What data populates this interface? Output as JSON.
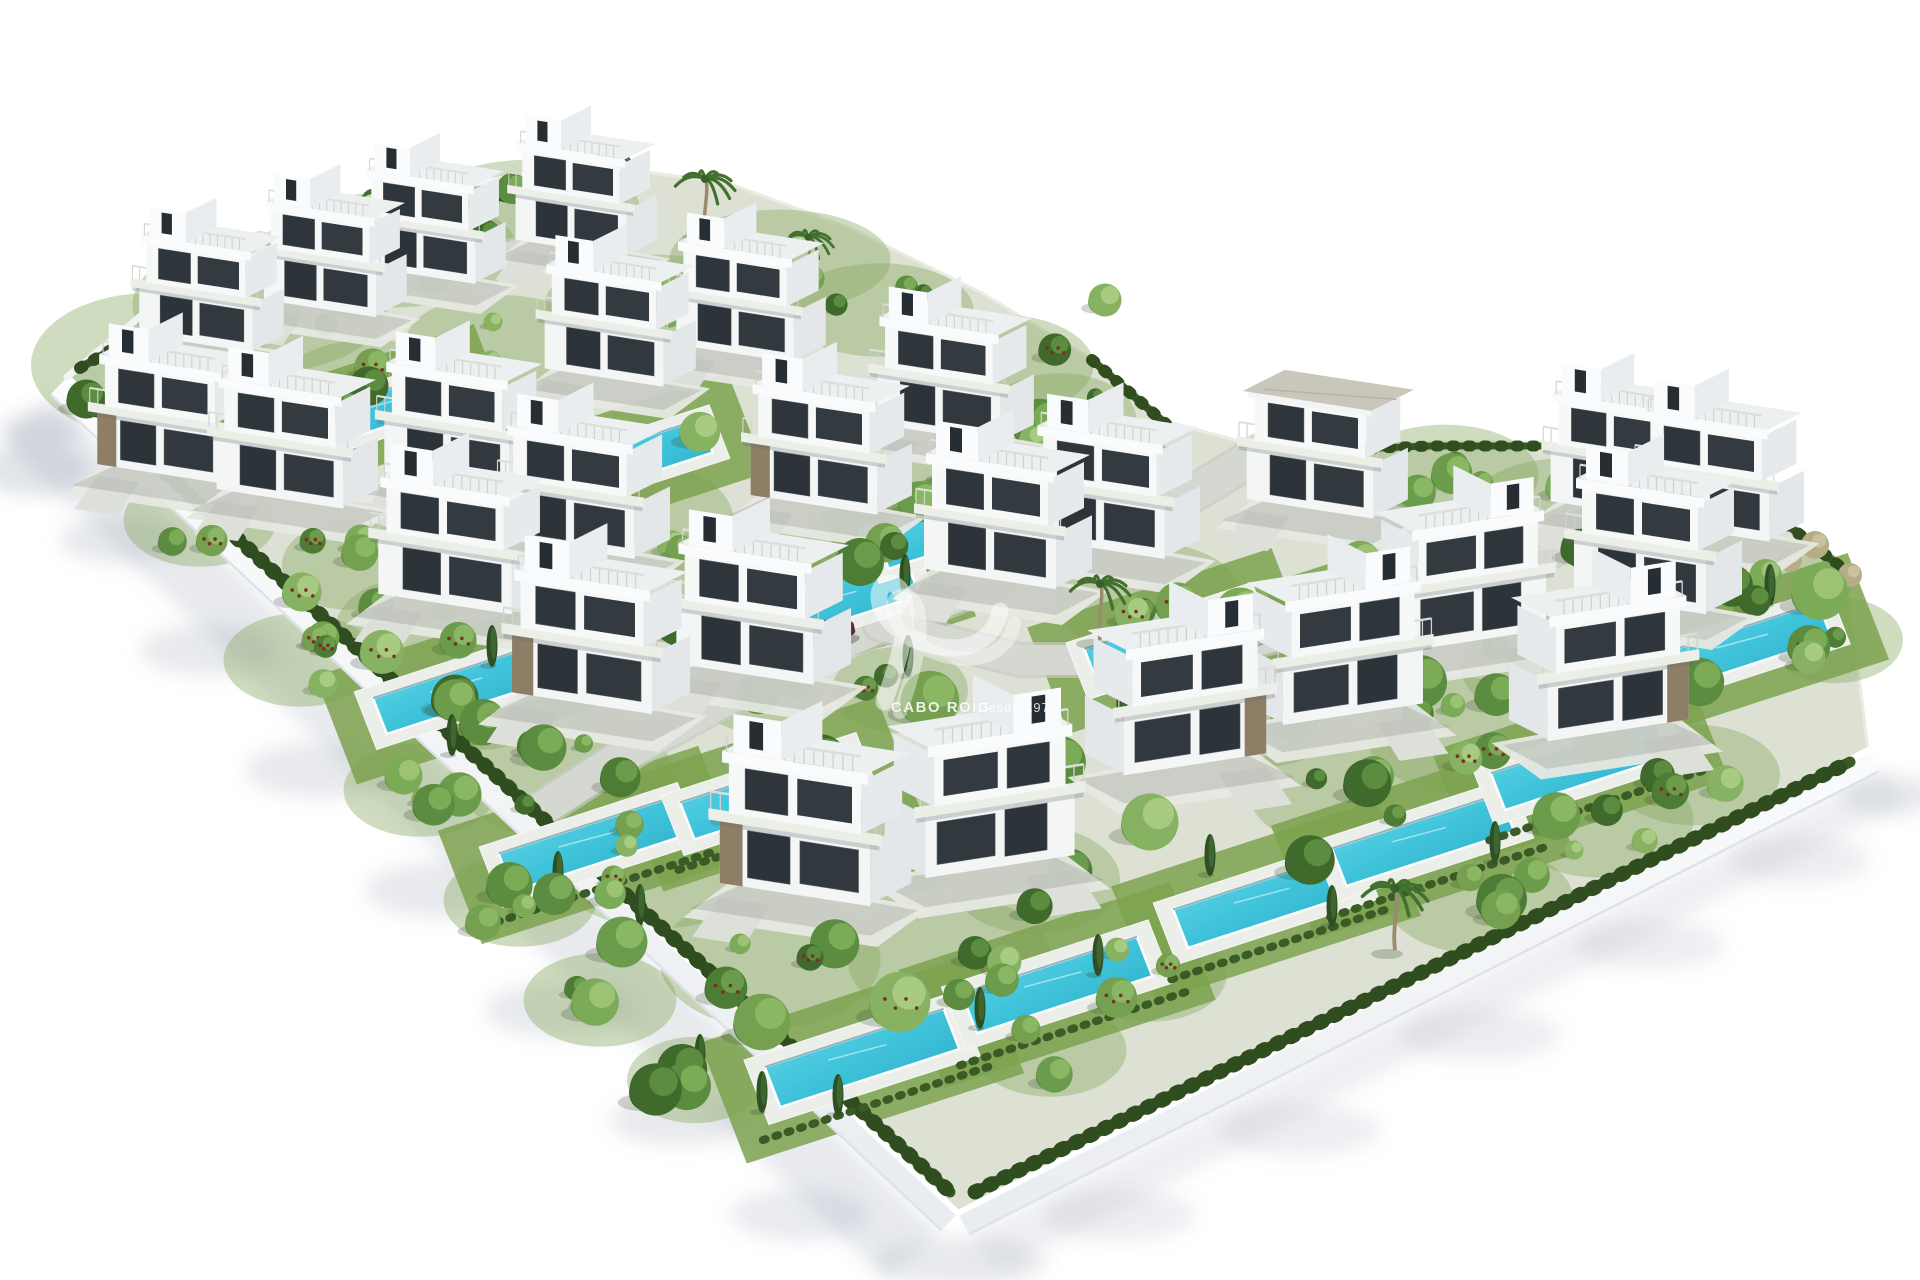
{
  "watermark": {
    "brand": "CABO ROIG",
    "tagline": "Desde 1970",
    "logo_icon": "siv-swoosh-monogram-icon"
  },
  "palette": {
    "background": "#ffffff",
    "ground": "#dde1d4",
    "grass": "#7ca24f",
    "grass_light": "#8fb161",
    "road": "#d5d8d1",
    "road_casing": "#c6cac2",
    "pad": "#e6e8e2",
    "wall_face": "#f3f5f7",
    "wall_edge": "#dfe3e8",
    "hedge": "#3a5a26",
    "hedge_dark": "#2f4d1f",
    "pool_water_light": "#5ad2e4",
    "pool_water_deep": "#2aa6c2",
    "pool_deck": "#eceeea",
    "villa_front": "#f4f6f6",
    "villa_side": "#e3e7ea",
    "villa_glass": "#2c343a",
    "stone_clad": "#8f7e66",
    "gray_roof": "#c9c6ba",
    "shadow_cool": "rgba(120,132,152,0.16)"
  },
  "scene": {
    "canvas": {
      "w": 1920,
      "h": 1280
    },
    "plot_outline": [
      [
        67,
        377
      ],
      [
        160,
        300
      ],
      [
        300,
        235
      ],
      [
        455,
        185
      ],
      [
        610,
        168
      ],
      [
        725,
        182
      ],
      [
        850,
        228
      ],
      [
        980,
        292
      ],
      [
        1090,
        358
      ],
      [
        1168,
        422
      ],
      [
        1272,
        450
      ],
      [
        1430,
        442
      ],
      [
        1545,
        442
      ],
      [
        1650,
        475
      ],
      [
        1755,
        495
      ],
      [
        1845,
        565
      ],
      [
        1868,
        750
      ],
      [
        958,
        1213
      ]
    ],
    "wall": {
      "width": 24,
      "edges": [
        {
          "from": [
            67,
            377
          ],
          "to": [
            958,
            1213
          ],
          "out": [
            -0.684,
            0.729
          ]
        },
        {
          "from": [
            958,
            1213
          ],
          "to": [
            1868,
            750
          ],
          "out": [
            0.453,
            0.891
          ]
        }
      ],
      "top_edge_line": [
        [
          67,
          377
        ],
        [
          160,
          300
        ],
        [
          300,
          235
        ],
        [
          455,
          185
        ],
        [
          610,
          168
        ]
      ]
    },
    "shadow_bands": [
      {
        "points": [
          [
            50,
            396
          ],
          [
            941,
            1232
          ],
          [
            885,
            1278
          ],
          [
            2,
            440
          ]
        ],
        "fill": "rgba(120,132,152,0.17)"
      },
      {
        "points": [
          [
            969,
            1234
          ],
          [
            1879,
            771
          ],
          [
            1908,
            802
          ],
          [
            999,
            1272
          ]
        ],
        "fill": "rgba(120,132,152,0.13)"
      }
    ],
    "shadow_blobs": [
      [
        35,
        470,
        55,
        26,
        0.22
      ],
      [
        120,
        540,
        60,
        24,
        0.18
      ],
      [
        210,
        650,
        70,
        26,
        0.18
      ],
      [
        320,
        770,
        75,
        28,
        0.18
      ],
      [
        440,
        890,
        75,
        28,
        0.18
      ],
      [
        560,
        1010,
        75,
        28,
        0.18
      ],
      [
        680,
        1120,
        70,
        26,
        0.18
      ],
      [
        800,
        1215,
        70,
        26,
        0.16
      ],
      [
        960,
        1262,
        85,
        24,
        0.18
      ],
      [
        1120,
        1215,
        75,
        26,
        0.14
      ],
      [
        1300,
        1130,
        80,
        26,
        0.14
      ],
      [
        1480,
        1035,
        80,
        26,
        0.14
      ],
      [
        1650,
        945,
        75,
        24,
        0.14
      ],
      [
        1800,
        860,
        70,
        24,
        0.14
      ],
      [
        1890,
        795,
        50,
        20,
        0.18
      ],
      [
        40,
        430,
        40,
        18,
        0.2
      ]
    ],
    "roads": [
      {
        "points": [
          [
            1268,
            448
          ],
          [
            1150,
            520
          ],
          [
            1000,
            578
          ],
          [
            880,
            625
          ],
          [
            760,
            680
          ],
          [
            640,
            745
          ],
          [
            540,
            810
          ]
        ],
        "width": 34
      },
      {
        "points": [
          [
            880,
            625
          ],
          [
            1020,
            660
          ],
          [
            1180,
            660
          ],
          [
            1320,
            625
          ],
          [
            1450,
            585
          ],
          [
            1555,
            550
          ]
        ],
        "width": 30
      },
      {
        "points": [
          [
            130,
            348
          ],
          [
            360,
            288
          ],
          [
            640,
            218
          ]
        ],
        "width": 18
      }
    ],
    "hedges": [
      {
        "points": [
          [
            95,
            408
          ],
          [
            950,
            1192
          ]
        ],
        "width": 11
      },
      {
        "points": [
          [
            975,
            1192
          ],
          [
            1850,
            762
          ]
        ],
        "width": 11
      },
      {
        "points": [
          [
            80,
            368
          ],
          [
            300,
            240
          ],
          [
            600,
            176
          ]
        ],
        "width": 8
      },
      {
        "points": [
          [
            1092,
            360
          ],
          [
            1166,
            424
          ]
        ],
        "width": 8
      },
      {
        "points": [
          [
            1276,
            452
          ],
          [
            1430,
            446
          ],
          [
            1540,
            446
          ]
        ],
        "width": 7
      },
      {
        "points": [
          [
            1652,
            480
          ],
          [
            1756,
            500
          ],
          [
            1842,
            568
          ]
        ],
        "width": 8
      }
    ],
    "villas": [
      {
        "x": 196,
        "y": 340,
        "s": 0.86
      },
      {
        "x": 320,
        "y": 305,
        "s": 0.85
      },
      {
        "x": 420,
        "y": 272,
        "s": 0.84
      },
      {
        "x": 571,
        "y": 245,
        "s": 0.84
      },
      {
        "x": 160,
        "y": 470,
        "s": 0.95,
        "stone": true
      },
      {
        "x": 604,
        "y": 374,
        "s": 0.9
      },
      {
        "x": 280,
        "y": 495,
        "s": 0.96
      },
      {
        "x": 447,
        "y": 478,
        "s": 0.95
      },
      {
        "x": 445,
        "y": 600,
        "s": 1.01
      },
      {
        "x": 570,
        "y": 545,
        "s": 0.98
      },
      {
        "x": 582,
        "y": 699,
        "s": 1.06,
        "stone": true
      },
      {
        "x": 745,
        "y": 670,
        "s": 1.04
      },
      {
        "x": 795,
        "y": 890,
        "s": 1.14,
        "stone": true
      },
      {
        "x": 1000,
        "y": 862,
        "s": 1.13,
        "flip": true
      },
      {
        "x": 814,
        "y": 501,
        "s": 0.96,
        "stone": true
      },
      {
        "x": 939,
        "y": 430,
        "s": 0.93
      },
      {
        "x": 735,
        "y": 350,
        "s": 0.89
      },
      {
        "x": 990,
        "y": 575,
        "s": 1.0
      },
      {
        "x": 1100,
        "y": 545,
        "s": 0.98
      },
      {
        "x": 1195,
        "y": 760,
        "s": 1.08,
        "flip": true,
        "stone": true
      },
      {
        "x": 1353,
        "y": 710,
        "s": 1.06,
        "flip": true
      },
      {
        "x": 1478,
        "y": 636,
        "s": 1.03,
        "flip": true
      },
      {
        "x": 1310,
        "y": 505,
        "s": 0.96,
        "roof": "gray"
      },
      {
        "x": 1612,
        "y": 507,
        "s": 0.93
      },
      {
        "x": 1706,
        "y": 528,
        "s": 0.96
      },
      {
        "x": 1640,
        "y": 600,
        "s": 1.0
      },
      {
        "x": 1618,
        "y": 726,
        "s": 1.07,
        "flip": true,
        "stone": true
      }
    ],
    "pools": [
      [
        380,
        410
      ],
      [
        632,
        460
      ],
      [
        460,
        690
      ],
      [
        590,
        845
      ],
      [
        770,
        794
      ],
      [
        835,
        603
      ],
      [
        958,
        527
      ],
      [
        862,
        1058
      ],
      [
        1057,
        985
      ],
      [
        1170,
        641
      ],
      [
        1266,
        901
      ],
      [
        1423,
        840
      ],
      [
        1580,
        765
      ],
      [
        1405,
        598
      ],
      [
        1746,
        646
      ]
    ],
    "palms": [
      [
        705,
        235,
        1.0
      ],
      [
        808,
        285,
        0.85
      ],
      [
        920,
        380,
        0.8
      ],
      [
        382,
        240,
        0.8
      ],
      [
        610,
        200,
        0.75
      ],
      [
        1100,
        640,
        1.0
      ],
      [
        1395,
        950,
        1.1
      ]
    ],
    "cypresses": [
      [
        492,
        646
      ],
      [
        905,
        575
      ],
      [
        700,
        1055
      ],
      [
        640,
        905
      ],
      [
        762,
        1092
      ],
      [
        980,
        1008
      ],
      [
        1210,
        855
      ],
      [
        1332,
        906
      ],
      [
        1495,
        842
      ],
      [
        1582,
        700
      ],
      [
        1660,
        625
      ],
      [
        1770,
        585
      ],
      [
        558,
        872
      ],
      [
        452,
        735
      ],
      [
        1122,
        702
      ],
      [
        908,
        656
      ],
      [
        838,
        1095
      ],
      [
        1098,
        955
      ]
    ],
    "cars": [
      {
        "x": 1245,
        "y": 638,
        "angle": -14,
        "color": "#3f444a"
      },
      {
        "x": 833,
        "y": 637,
        "angle": -12,
        "color": "#552f36"
      }
    ],
    "tree_singles": [
      [
        1040,
        425,
        30
      ],
      [
        1105,
        300,
        20
      ],
      [
        612,
        500,
        26
      ],
      [
        520,
        432,
        23
      ],
      [
        860,
        562,
        26
      ],
      [
        930,
        700,
        30
      ],
      [
        820,
        762,
        28
      ],
      [
        680,
        622,
        26
      ],
      [
        562,
        662,
        24
      ],
      [
        480,
        562,
        23
      ],
      [
        1240,
        612,
        26
      ],
      [
        1420,
        682,
        28
      ],
      [
        1520,
        602,
        25
      ],
      [
        1602,
        742,
        27
      ],
      [
        1700,
        682,
        25
      ],
      [
        352,
        302,
        21
      ],
      [
        252,
        362,
        21
      ],
      [
        452,
        372,
        21
      ],
      [
        700,
        432,
        23
      ],
      [
        1150,
        822,
        28
      ],
      [
        1060,
        762,
        26
      ],
      [
        900,
        1002,
        28
      ],
      [
        762,
        1022,
        26
      ],
      [
        622,
        942,
        24
      ],
      [
        1500,
        502,
        21
      ],
      [
        1580,
        548,
        21
      ],
      [
        1360,
        562,
        23
      ],
      [
        282,
        482,
        21
      ],
      [
        382,
        652,
        23
      ],
      [
        302,
        592,
        21
      ],
      [
        1820,
        592,
        30
      ],
      [
        1760,
        505,
        22
      ],
      [
        970,
        840,
        24
      ],
      [
        1310,
        860,
        24
      ]
    ],
    "dry_shrubs": [
      [
        1815,
        545,
        14
      ],
      [
        1850,
        575,
        12
      ],
      [
        1790,
        560,
        12
      ],
      [
        1120,
        470,
        12
      ],
      [
        1160,
        455,
        10
      ]
    ],
    "tree_clusters": [
      [
        150,
        365,
        70,
        40,
        5
      ],
      [
        260,
        305,
        75,
        38,
        5
      ],
      [
        390,
        250,
        75,
        32,
        4
      ],
      [
        530,
        210,
        65,
        28,
        4
      ],
      [
        250,
        430,
        60,
        30,
        4
      ],
      [
        370,
        390,
        55,
        28,
        3
      ],
      [
        500,
        340,
        55,
        25,
        3
      ],
      [
        655,
        305,
        65,
        28,
        4
      ],
      [
        780,
        260,
        65,
        28,
        4
      ],
      [
        880,
        310,
        55,
        26,
        3
      ],
      [
        1000,
        365,
        55,
        28,
        4
      ],
      [
        1060,
        420,
        45,
        26,
        3
      ],
      [
        640,
        520,
        55,
        32,
        4
      ],
      [
        745,
        565,
        45,
        28,
        3
      ],
      [
        880,
        525,
        45,
        26,
        3
      ],
      [
        950,
        478,
        40,
        24,
        3
      ],
      [
        560,
        770,
        65,
        38,
        5
      ],
      [
        660,
        860,
        65,
        38,
        4
      ],
      [
        770,
        960,
        65,
        38,
        4
      ],
      [
        880,
        850,
        55,
        32,
        4
      ],
      [
        950,
        960,
        60,
        36,
        4
      ],
      [
        1035,
        880,
        50,
        30,
        3
      ],
      [
        420,
        630,
        50,
        30,
        3
      ],
      [
        350,
        565,
        40,
        25,
        3
      ],
      [
        480,
        705,
        40,
        25,
        3
      ],
      [
        1150,
        600,
        55,
        32,
        3
      ],
      [
        1250,
        700,
        65,
        38,
        4
      ],
      [
        1350,
        790,
        60,
        34,
        4
      ],
      [
        1460,
        735,
        55,
        32,
        4
      ],
      [
        1545,
        665,
        50,
        30,
        3
      ],
      [
        1600,
        820,
        55,
        32,
        4
      ],
      [
        1695,
        775,
        50,
        28,
        3
      ],
      [
        1480,
        900,
        55,
        30,
        4
      ],
      [
        1445,
        475,
        55,
        28,
        4
      ],
      [
        1565,
        505,
        55,
        26,
        3
      ],
      [
        1680,
        545,
        45,
        24,
        3
      ],
      [
        1775,
        585,
        45,
        26,
        4
      ],
      [
        1835,
        640,
        40,
        24,
        3
      ],
      [
        900,
        690,
        40,
        24,
        2
      ],
      [
        760,
        690,
        38,
        24,
        2
      ],
      [
        200,
        520,
        45,
        26,
        4
      ],
      [
        300,
        660,
        45,
        26,
        4
      ],
      [
        420,
        790,
        45,
        26,
        4
      ],
      [
        520,
        900,
        45,
        26,
        4
      ],
      [
        600,
        1000,
        45,
        26,
        3
      ],
      [
        695,
        1080,
        40,
        24,
        3
      ],
      [
        1050,
        1050,
        45,
        26,
        3
      ],
      [
        1150,
        975,
        45,
        26,
        3
      ]
    ]
  }
}
